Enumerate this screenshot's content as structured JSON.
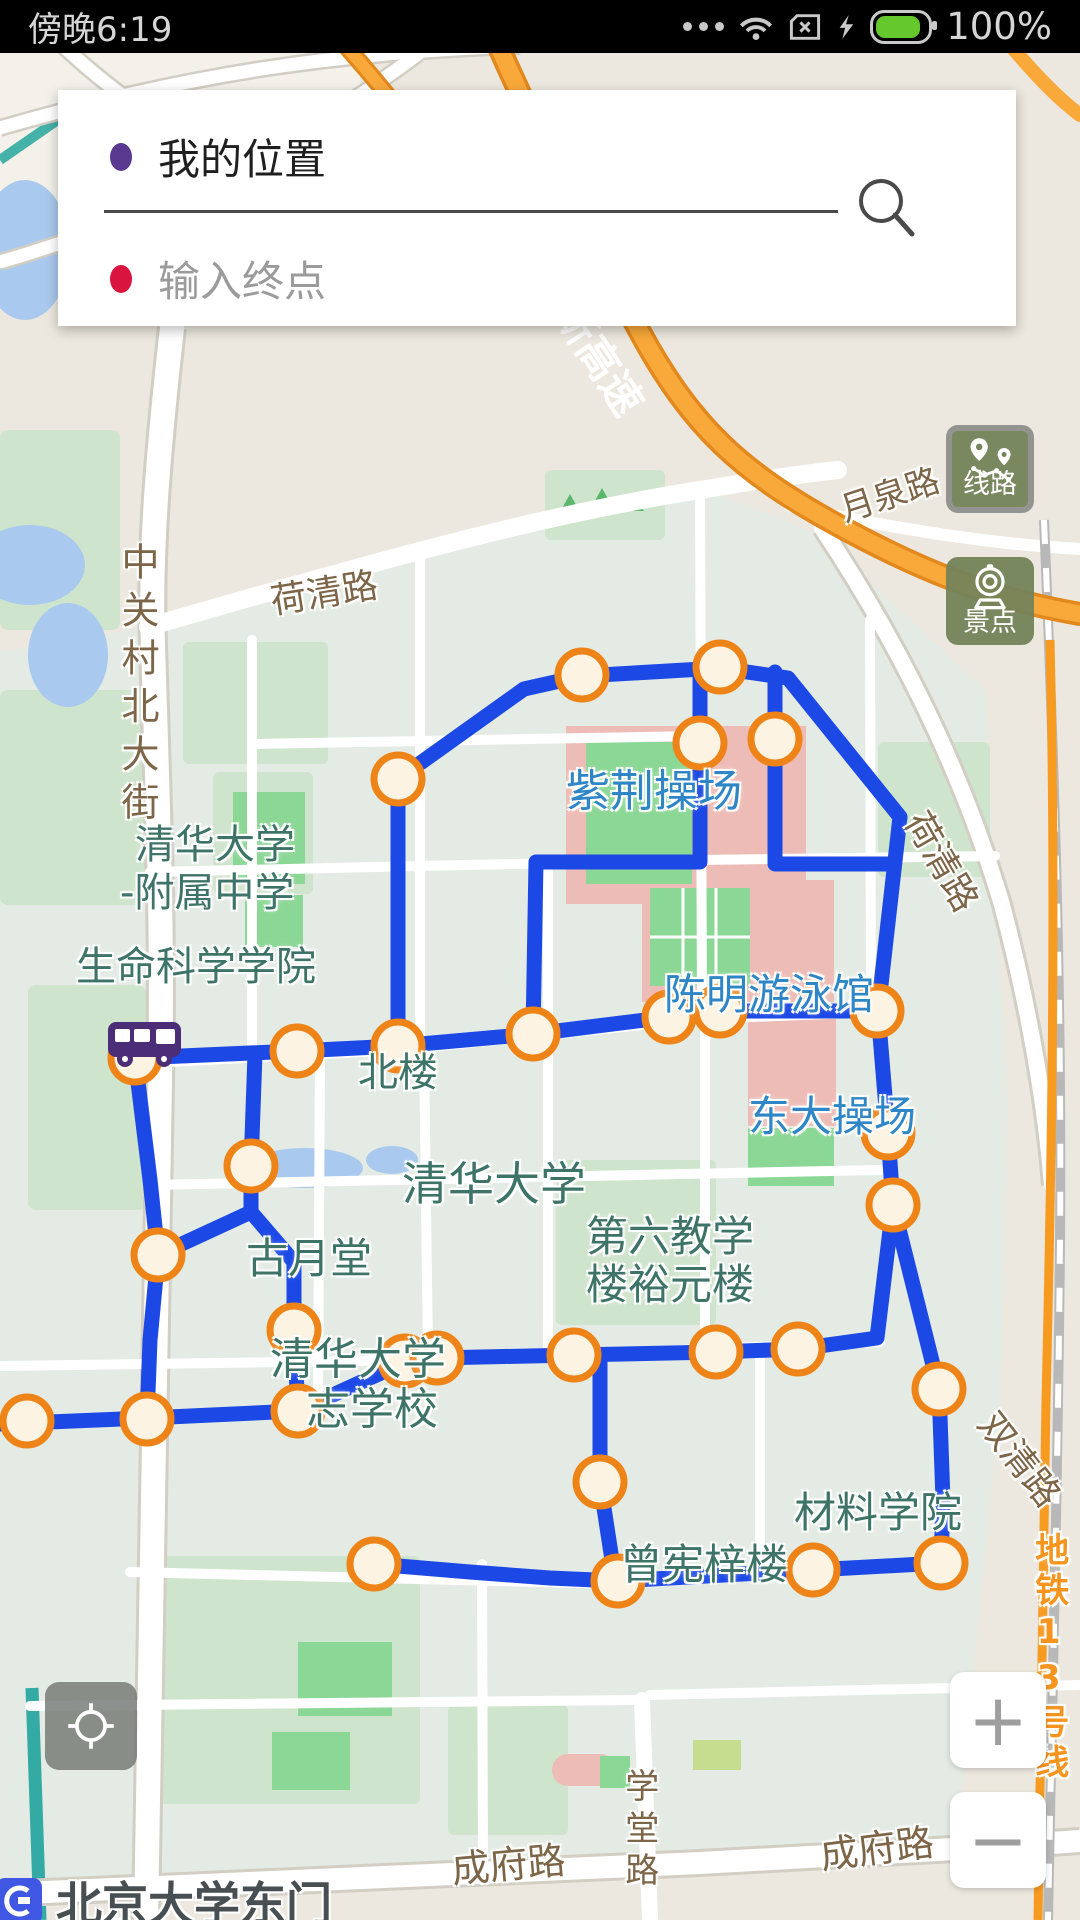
{
  "status_bar": {
    "time": "傍晚6:19",
    "battery_label": "100%",
    "colors": {
      "bg": "#000000",
      "fg": "#d5d5d5",
      "battery_fill": "#65c82d"
    }
  },
  "search_card": {
    "origin": {
      "label": "我的位置",
      "dot_color": "#5a3a90"
    },
    "destination": {
      "placeholder": "输入终点",
      "dot_color": "#d9143e"
    }
  },
  "side_buttons": [
    {
      "id": "routes",
      "label": "线路",
      "icon": "route-pins-icon",
      "active": true
    },
    {
      "id": "spots",
      "label": "景点",
      "icon": "scenic-camera-icon",
      "active": false
    }
  ],
  "zoom_controls": {
    "zoom_in": "+",
    "zoom_out": "−"
  },
  "station": {
    "name": "北京大学东门",
    "logo_color": "#3f57e3"
  },
  "map": {
    "colors": {
      "campus": "#e3ebe4",
      "outside": "#ece8df",
      "park": "#cfe4cc",
      "field": "#8bd795",
      "building_pink": "#eebcb6",
      "water": "#aac9ee",
      "canal": "#33aaa4",
      "road_label": "#7d6548",
      "poi_teal": "#3d7467",
      "poi_blue": "#2e86c6",
      "metro_orange": "#f79a20",
      "highway_orange": "#f9a93a"
    },
    "labels": [
      {
        "text": "京新高速",
        "x": 560,
        "y": 258,
        "size": 42,
        "color": "#ffffff",
        "rotate": 57,
        "bold": true,
        "halo": false
      },
      {
        "text": "月泉路",
        "x": 836,
        "y": 494,
        "size": 34,
        "color": "#7d6548",
        "rotate": -18
      },
      {
        "text": "荷清路",
        "x": 268,
        "y": 584,
        "size": 36,
        "color": "#7d6548",
        "rotate": -9
      },
      {
        "text": "中关村北大街",
        "x": 116,
        "y": 542,
        "size": 38,
        "color": "#7d6548",
        "vertical": true,
        "lspace": 10
      },
      {
        "text": "荷清路",
        "x": 930,
        "y": 806,
        "size": 36,
        "color": "#7d6548",
        "rotate": 60
      },
      {
        "text": "双清路",
        "x": 1000,
        "y": 1406,
        "size": 36,
        "color": "#7d6548",
        "rotate": 52
      },
      {
        "text": "地铁13号线",
        "x": 1030,
        "y": 1532,
        "size": 34,
        "color": "#f7941d",
        "vertical": true,
        "bold": true,
        "lspace": 6
      },
      {
        "text": "学堂路",
        "x": 620,
        "y": 1768,
        "size": 34,
        "color": "#7d6548",
        "vertical": true,
        "lspace": 8
      },
      {
        "text": "成府路",
        "x": 450,
        "y": 1850,
        "size": 38,
        "color": "#7d6548",
        "rotate": -5
      },
      {
        "text": "成府路",
        "x": 818,
        "y": 1836,
        "size": 38,
        "color": "#7d6548",
        "rotate": -7
      },
      {
        "text": "清华大学",
        "x": 135,
        "y": 824,
        "size": 40,
        "color": "#3d7467"
      },
      {
        "text": "-附属中学",
        "x": 120,
        "y": 872,
        "size": 40,
        "color": "#3d7467"
      },
      {
        "text": "生命科学学院",
        "x": 76,
        "y": 946,
        "size": 40,
        "color": "#3d7467"
      },
      {
        "text": "北楼",
        "x": 358,
        "y": 1052,
        "size": 40,
        "color": "#3d7467"
      },
      {
        "text": "紫荆操场",
        "x": 566,
        "y": 768,
        "size": 44,
        "color": "#2e86c6"
      },
      {
        "text": "陈明游泳馆",
        "x": 664,
        "y": 972,
        "size": 42,
        "color": "#2e86c6"
      },
      {
        "text": "东大操场",
        "x": 748,
        "y": 1094,
        "size": 42,
        "color": "#2e86c6"
      },
      {
        "text": "清华大学",
        "x": 402,
        "y": 1160,
        "size": 46,
        "color": "#3d7467"
      },
      {
        "text": "古月堂",
        "x": 246,
        "y": 1236,
        "size": 42,
        "color": "#3d7467"
      },
      {
        "text": "第六教学",
        "x": 586,
        "y": 1214,
        "size": 42,
        "color": "#3d7467"
      },
      {
        "text": "楼裕元楼",
        "x": 586,
        "y": 1262,
        "size": 42,
        "color": "#3d7467"
      },
      {
        "text": "清华大学",
        "x": 270,
        "y": 1336,
        "size": 44,
        "color": "#3d7467"
      },
      {
        "text": "志学校",
        "x": 306,
        "y": 1386,
        "size": 44,
        "color": "#3d7467"
      },
      {
        "text": "材料学院",
        "x": 794,
        "y": 1490,
        "size": 42,
        "color": "#3d7467"
      },
      {
        "text": "曾宪梓楼",
        "x": 620,
        "y": 1542,
        "size": 42,
        "color": "#3d7467"
      }
    ]
  },
  "route": {
    "color": "#1c49e6",
    "width": 15,
    "stop_fill": "#fdf3e2",
    "stop_stroke": "#ee8418",
    "stop_radius": 24,
    "stop_stroke_width": 7,
    "paths": [
      "M398 1046 L398 779 L524 689 L582 676 L720 668 L788 678 L900 817 L878 1011",
      "M700 668 L700 862 L536 862 L533 1034",
      "M775 672 L775 864 L893 864",
      "M135 1058 L297 1051 L398 1046 L533 1034 L669 1017 L720 1011 L878 1011",
      "M135 1058 L150 1180 L158 1255 L150 1340 L147 1419",
      "M0 1424 L147 1418 L298 1411 L405 1362 L437 1358 L574 1355 L716 1352 L798 1349 L877 1338 L893 1205",
      "M878 1011 L888 1133 L893 1205 L939 1389 L943 1500 L941 1563",
      "M374 1564 L470 1572 L550 1578 L618 1581 L813 1570 L941 1563",
      "M600 1357 L600 1482 L612 1560 L618 1581",
      "M255 1054 L251 1166 L251 1212 L158 1255",
      "M251 1212 L294 1262 L294 1330 L298 1411"
    ],
    "stops": [
      [
        582,
        675
      ],
      [
        720,
        667
      ],
      [
        700,
        743
      ],
      [
        775,
        739
      ],
      [
        398,
        779
      ],
      [
        135,
        1058
      ],
      [
        297,
        1051
      ],
      [
        398,
        1046
      ],
      [
        533,
        1034
      ],
      [
        669,
        1017
      ],
      [
        720,
        1011
      ],
      [
        877,
        1011
      ],
      [
        888,
        1133
      ],
      [
        893,
        1205
      ],
      [
        939,
        1389
      ],
      [
        251,
        1166
      ],
      [
        158,
        1255
      ],
      [
        294,
        1330
      ],
      [
        147,
        1419
      ],
      [
        27,
        1421
      ],
      [
        298,
        1411
      ],
      [
        405,
        1361
      ],
      [
        437,
        1358
      ],
      [
        574,
        1355
      ],
      [
        716,
        1352
      ],
      [
        798,
        1349
      ],
      [
        600,
        1482
      ],
      [
        618,
        1581
      ],
      [
        374,
        1564
      ],
      [
        813,
        1570
      ],
      [
        941,
        1563
      ]
    ]
  }
}
